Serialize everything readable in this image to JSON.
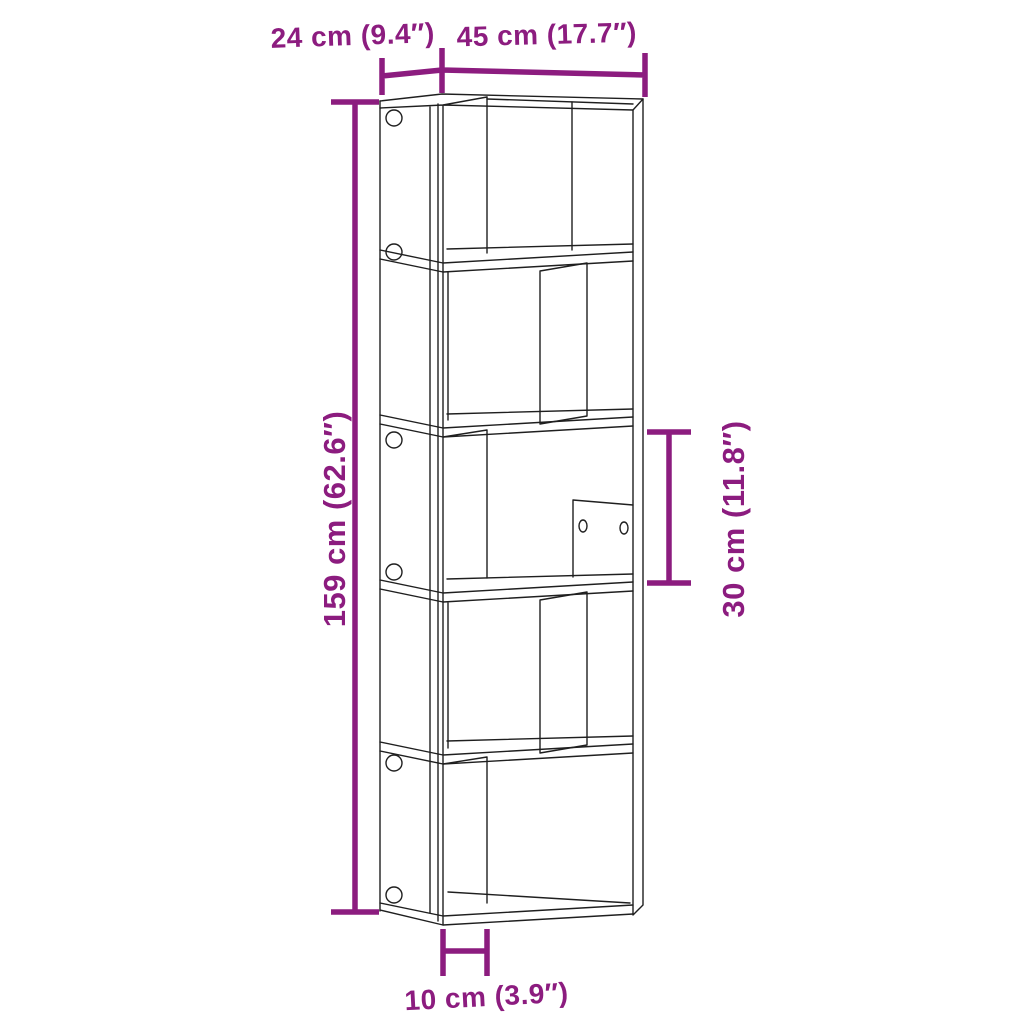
{
  "colors": {
    "dimension": "#8C1C7F",
    "line_art": "#1f1f1f",
    "background": "#ffffff"
  },
  "dimension_labels": {
    "depth": "24 cm (9.4″)",
    "width": "45 cm (17.7″)",
    "height": "159 cm (62.6″)",
    "compartment_height": "30 cm (11.8″)",
    "foot_clearance": "10 cm (3.9″)"
  }
}
